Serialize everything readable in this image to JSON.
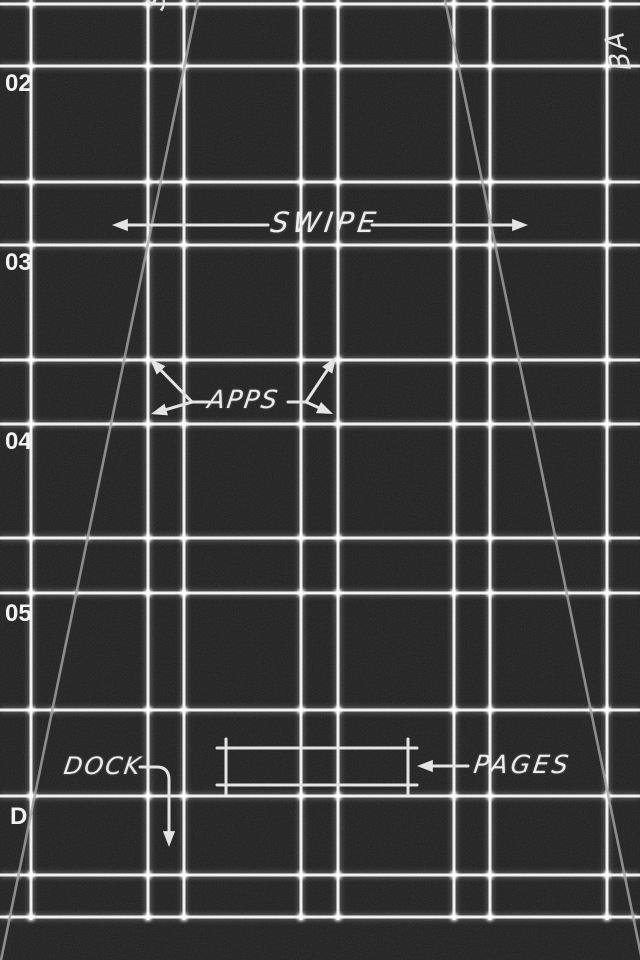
{
  "wallpaper": {
    "colors": {
      "background": "#1d1d1d",
      "grid": "#ffffff",
      "annotation": "#e4e4e4",
      "diagonal": "#a6a6a6"
    },
    "grid": {
      "vertical_x": [
        31,
        148,
        184,
        301,
        338,
        454,
        490,
        607
      ],
      "vertical_y_range": [
        0,
        920
      ],
      "horizontal_y": [
        4,
        66,
        182,
        245,
        360,
        424,
        538,
        593,
        710,
        796,
        875,
        917
      ],
      "horizontal_x_range": [
        0,
        640
      ],
      "line_width": 3
    },
    "diagonals": [
      {
        "x1": 198,
        "y1": 0,
        "x2": 0,
        "y2": 965
      },
      {
        "x1": 445,
        "y1": 0,
        "x2": 642,
        "y2": 960
      }
    ],
    "row_labels": [
      {
        "text": "02",
        "x": 5,
        "y": 70
      },
      {
        "text": "03",
        "x": 5,
        "y": 249
      },
      {
        "text": "04",
        "x": 5,
        "y": 428
      },
      {
        "text": "05",
        "x": 5,
        "y": 600
      },
      {
        "text": "D",
        "x": 10,
        "y": 803
      }
    ],
    "annotations": {
      "swipe": {
        "label": "SWIPE",
        "text_x": 271,
        "text_y": 206,
        "left_line": {
          "from": [
            268,
            225
          ],
          "tip": [
            112,
            225
          ],
          "dir": 180
        },
        "right_line": {
          "from": [
            372,
            225
          ],
          "tip": [
            528,
            225
          ],
          "dir": 0
        }
      },
      "apps": {
        "label": "APPS",
        "text_x": 208,
        "text_y": 385,
        "left": {
          "junction": [
            192,
            402
          ],
          "connector": [
            209,
            402
          ],
          "tips": [
            [
              150,
              359
            ],
            [
              151,
              414
            ]
          ]
        },
        "right": {
          "junction": [
            306,
            402
          ],
          "connector": [
            288,
            402
          ],
          "tips": [
            [
              336,
              357
            ],
            [
              333,
              414
            ]
          ]
        }
      },
      "dock": {
        "label": "DOCK",
        "text_x": 64,
        "text_y": 752,
        "elbow_start": [
          140,
          767
        ],
        "elbow_corner": [
          169,
          780
        ],
        "elbow_end": [
          169,
          834
        ],
        "arrow_tip": [
          169,
          847
        ],
        "arrow_dir": 90
      },
      "pages": {
        "label": "PAGES",
        "text_x": 474,
        "text_y": 750,
        "box": {
          "x1": 226,
          "y1": 748,
          "x2": 408,
          "y2": 785,
          "tick": 9
        },
        "arrow_from": [
          468,
          766
        ],
        "arrow_tip": [
          417,
          766
        ],
        "arrow_dir": 180
      },
      "fragments": {
        "top_left": {
          "text": "S",
          "x": 140,
          "y": 4,
          "rotate": -78
        },
        "top_right": {
          "text": "BA",
          "x": 607,
          "y": 72,
          "rotate": -102
        }
      }
    }
  }
}
